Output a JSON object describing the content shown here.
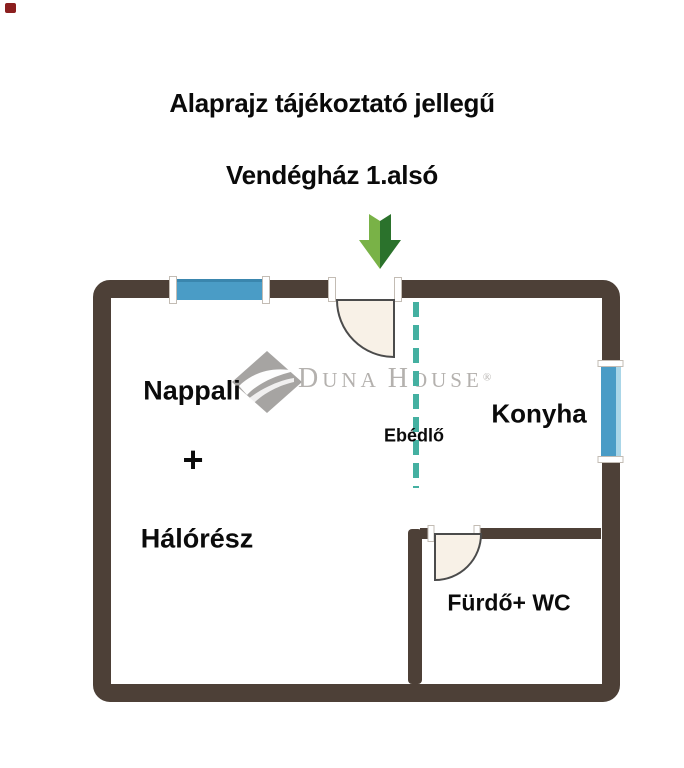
{
  "header": {
    "title": "Alaprajz tájékoztató jellegű",
    "subtitle": "Vendégház 1.alsó"
  },
  "watermark": {
    "d": "D",
    "una": "UNA",
    "h": "H",
    "ouse": "OUSE",
    "reg": "®"
  },
  "rooms": {
    "living": "Nappali",
    "plus": "+",
    "sleeping": "Hálórész",
    "dining": "Ebédlő",
    "kitchen": "Konyha",
    "bathroom": "Fürdő+ WC"
  },
  "colors": {
    "wall": "#4d4037",
    "window": "#4a9cc6",
    "window_dark": "#3a86ae",
    "window_light": "#aad6e8",
    "door_fill": "#f8f1e7",
    "door_line": "#4b4b4b",
    "divider": "#44b0a1",
    "arrow_light": "#79b247",
    "arrow_dark": "#2b722c",
    "watermark": "#b4b1ae",
    "text": "#0a0a0a"
  }
}
